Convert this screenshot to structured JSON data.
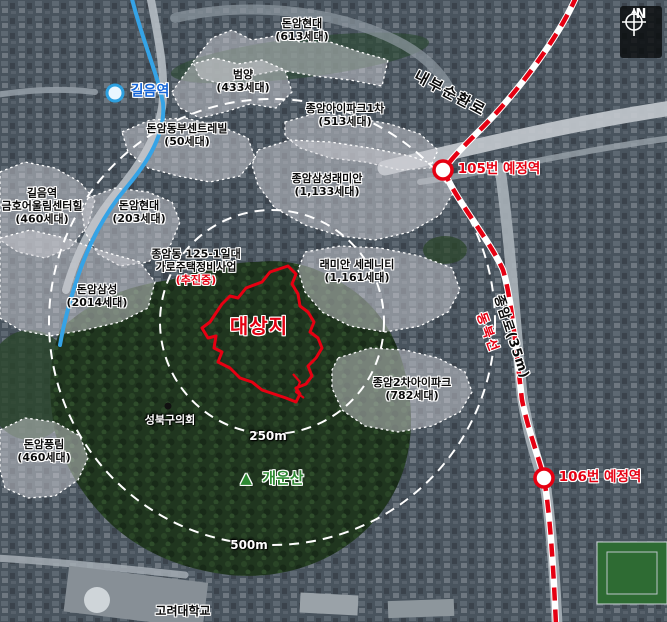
{
  "map_title": "site-location-satellite-map",
  "colors": {
    "site_outline": "#e60012",
    "planned_rail": "#e60012",
    "subway_line": "#35a3e6",
    "radius_circles": "#ffffff",
    "mountain_label": "#2e8b33",
    "station_label_blue": "#1565d8"
  },
  "complexes": [
    {
      "name": "돈암현대",
      "units": "(613세대)"
    },
    {
      "name": "범양",
      "units": "(433세대)"
    },
    {
      "name": "종암아이파크1차",
      "units": "(513세대)"
    },
    {
      "name": "돈암동부센트레빌",
      "units": "(50세대)"
    },
    {
      "name": "길음역",
      "name2": "금호어울림센터힐",
      "units": "(460세대)"
    },
    {
      "name": "돈암현대",
      "units": "(203세대)"
    },
    {
      "name": "돈암삼성",
      "units": "(2014세대)"
    },
    {
      "name": "돈암풍림",
      "units": "(460세대)"
    },
    {
      "name": "종암삼성래미안",
      "units": "(1,133세대)"
    },
    {
      "name": "래미안 세레니티",
      "units": "(1,161세대)"
    },
    {
      "name": "종암2차아이파크",
      "units": "(782세대)"
    }
  ],
  "project": {
    "line1": "종암동 125-1일대",
    "line2": "가로주택정비사업",
    "line3": "(추진중)"
  },
  "site": {
    "label": "대상지"
  },
  "stations": {
    "gireum": "길음역",
    "s105": "105번 예정역",
    "s106": "106번 예정역"
  },
  "roads": {
    "naebu": "내부순환로",
    "jongam": "종암로(35m)",
    "dongbuk": "동북선"
  },
  "landmarks": {
    "council": "성북구의회",
    "mountain_marker": "▲",
    "mountain": "개운산",
    "university": "고려대학교"
  },
  "radii": {
    "inner": "250m",
    "outer": "500m"
  },
  "compass": {
    "north": "N"
  }
}
